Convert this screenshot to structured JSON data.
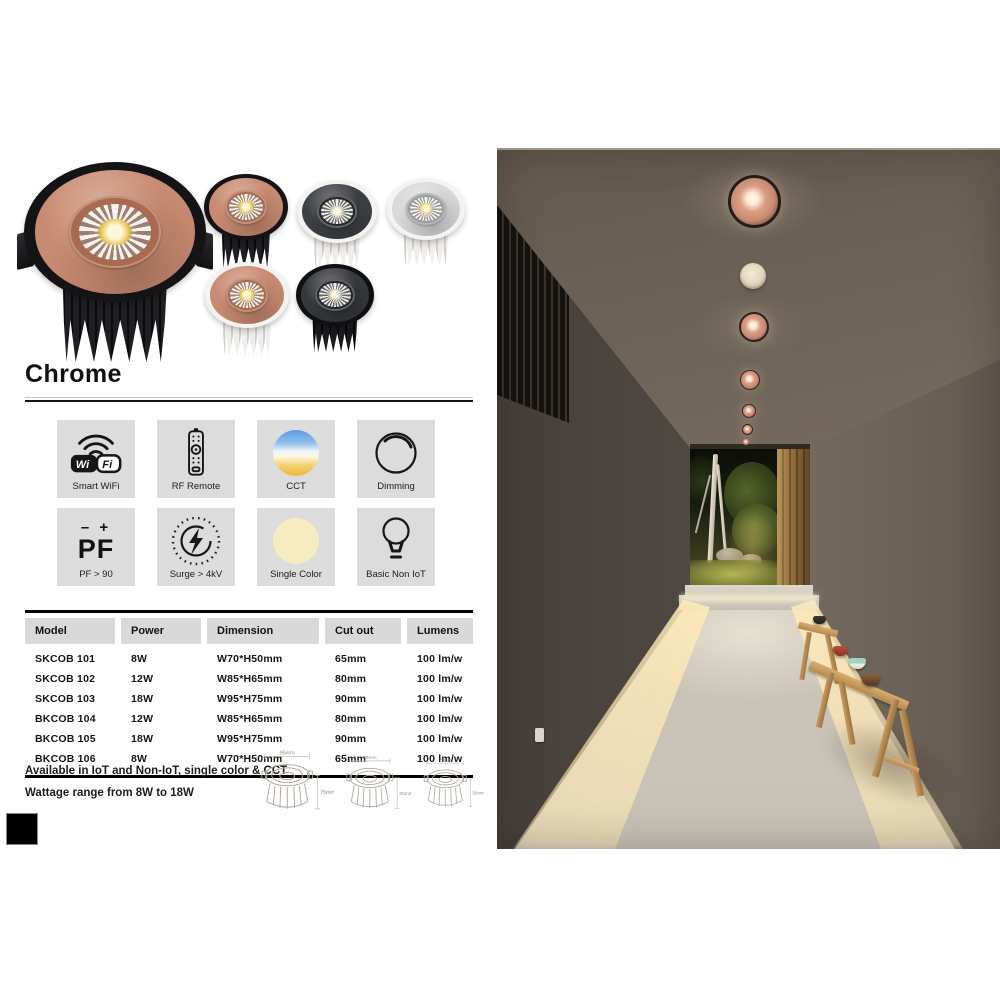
{
  "header": {
    "title": "Chrome"
  },
  "products": {
    "variants": [
      {
        "name": "rose-gold-face-black-body-large",
        "face": "#c98a72",
        "body": "#1f1f23",
        "body2": "#0b0b0e",
        "bezel": "#141417",
        "ring": "#a96a50",
        "led": "#ecc95f"
      },
      {
        "name": "rose-gold-face-black-body",
        "face": "#c98a72",
        "body": "#1f1f23",
        "body2": "#0b0b0e",
        "bezel": "#141417",
        "ring": "#a96a50",
        "led": "#ecc95f"
      },
      {
        "name": "black-face-white-body",
        "face": "#3c4044",
        "body": "#efeeec",
        "body2": "#d2cec7",
        "bezel": "#f4f3f1",
        "ring": "#26292c",
        "led": "#cfd4cc"
      },
      {
        "name": "chrome-face-white-body",
        "face": "#d7d8da",
        "body": "#efeeec",
        "body2": "#d2cec7",
        "bezel": "#f4f3f1",
        "ring": "#9b9da1",
        "led": "#e8d27a"
      },
      {
        "name": "rose-gold-face-white-body",
        "face": "#c98a72",
        "body": "#efeeec",
        "body2": "#d2cec7",
        "bezel": "#f4f3f1",
        "ring": "#a96a50",
        "led": "#ecc95f"
      },
      {
        "name": "black-face-black-body",
        "face": "#35383c",
        "body": "#1a1a1d",
        "body2": "#08080a",
        "bezel": "#101013",
        "ring": "#22252a",
        "led": "#c9cec6"
      }
    ]
  },
  "features": [
    {
      "label": "Smart WiFi",
      "icon": "wifi-icon"
    },
    {
      "label": "RF Remote",
      "icon": "rf-remote-icon"
    },
    {
      "label": "CCT",
      "icon": "cct-gradient-icon"
    },
    {
      "label": "Dimming",
      "icon": "dimming-dial-icon"
    },
    {
      "label": "PF > 90",
      "icon": "power-factor-icon"
    },
    {
      "label": "Surge > 4kV",
      "icon": "surge-protection-icon"
    },
    {
      "label": "Single Color",
      "icon": "single-color-icon"
    },
    {
      "label": "Basic Non IoT",
      "icon": "bulb-icon"
    }
  ],
  "icon_texts": {
    "wifi_wi": "Wi",
    "wifi_fi": "Fi",
    "pf_signs": "– +",
    "pf_label": "PF"
  },
  "spec_table": {
    "headers": [
      "Model",
      "Power",
      "Dimension",
      "Cut out",
      "Lumens"
    ],
    "rows": [
      [
        "SKCOB 101",
        "8W",
        "W70*H50mm",
        "65mm",
        "100 lm/w"
      ],
      [
        "SKCOB 102",
        "12W",
        "W85*H65mm",
        "80mm",
        "100 lm/w"
      ],
      [
        "SKCOB 103",
        "18W",
        "W95*H75mm",
        "90mm",
        "100 lm/w"
      ],
      [
        "BKCOB 104",
        "12W",
        "W85*H65mm",
        "80mm",
        "100 lm/w"
      ],
      [
        "BKCOB 105",
        "18W",
        "W95*H75mm",
        "90mm",
        "100 lm/w"
      ],
      [
        "BKCOB 106",
        "8W",
        "W70*H50mm",
        "65mm",
        "100 lm/w"
      ]
    ]
  },
  "notes": [
    "Available in IoT and Non-IoT, single color & CCT",
    "Wattage range from 8W to 18W"
  ],
  "drawings": [
    {
      "width_label": "95mm",
      "height_label": "75mm"
    },
    {
      "width_label": "85mm",
      "height_label": "65mm"
    },
    {
      "width_label": "70mm",
      "height_label": "50mm"
    }
  ],
  "photo": {
    "colors": {
      "ceiling": "#75695d",
      "wall_left": "#544d46",
      "wall_right": "#7b7064",
      "floor": "#ccc5b9",
      "glow": "#fff3d6",
      "wood": "#96713e",
      "downlight_trim": "#c98a73",
      "detector": "#f3ead6"
    }
  }
}
